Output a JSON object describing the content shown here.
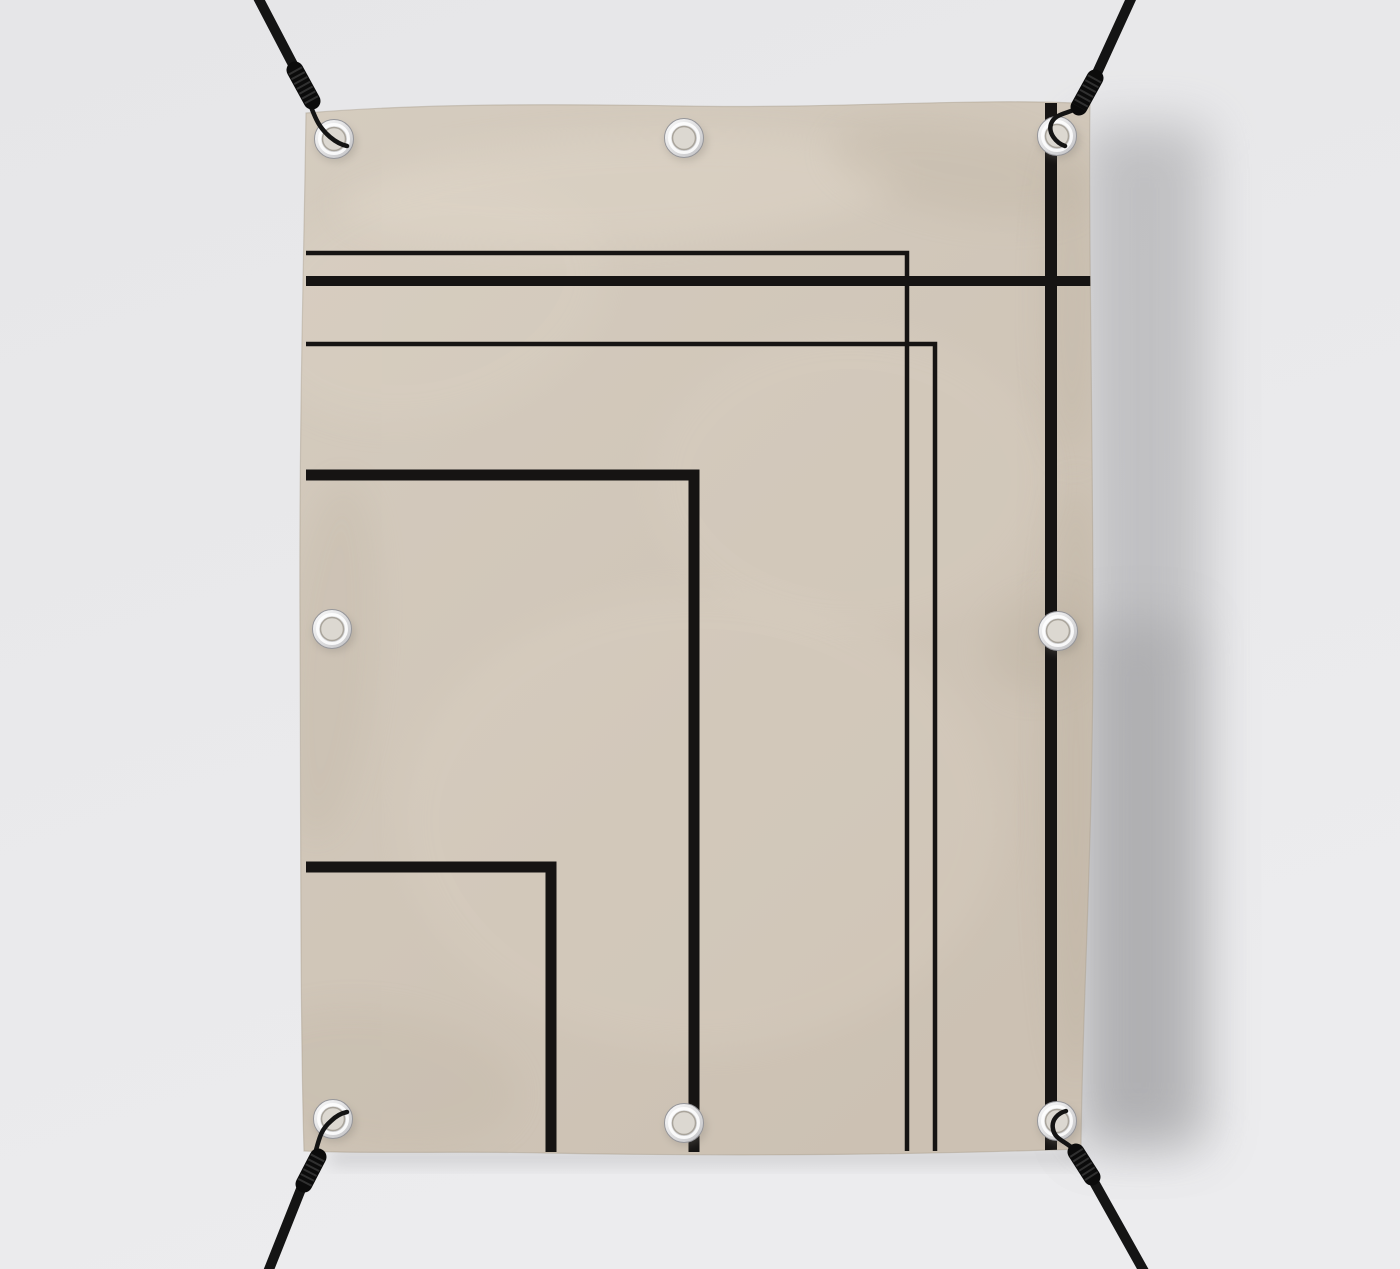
{
  "scene": {
    "description": "Beige fabric banner mockup hung by black bungee cords hooked through eight silver grommets, printed with a minimalist black geometric line pattern of nested corner frames, casting a soft shadow on a light gray wall",
    "canvas": {
      "width": 1400,
      "height": 1269
    },
    "palette": {
      "wall_top": "#e6e6e8",
      "wall_bottom": "#ececee",
      "wall_shadow": "#8f8f92",
      "under_shadow": "#a5a5a7",
      "fabric_top": "#d5ccbf",
      "fabric_bottom": "#ccc1b3",
      "fabric_shade": "#b3a795",
      "fabric_light": "#e6ddcf",
      "edge_tint": "#a99d8c",
      "line": "#161413",
      "cord": "#141414",
      "cord_coil": "#0b0b0b",
      "coil_ridge": "#3a3a3a",
      "ring_light": "#fdfdfd",
      "ring_dark": "#c0c0c3",
      "ring_rim": "#96969a",
      "ring_highlight": "#ffffff",
      "hole_fill": "#dcd8d1",
      "hole_rim": "#a9a49b",
      "grommet_shadow": "#7d786f"
    },
    "banner": {
      "outline": "M 306,113 C 430,103 560,104 683,106 C 840,109 985,97 1090,104 C 1088,200 1093,430 1093,630 C 1093,850 1082,1010 1081,1149 C 930,1154 760,1157 545,1153 C 460,1151 368,1154 304,1151 C 300,1010 301,820 300,632 C 299,420 304,260 306,113 Z"
    },
    "pattern_lines": [
      {
        "name": "thin-frame-upper",
        "points": "306,253 907,253 907,1151",
        "width": 4.5
      },
      {
        "name": "thick-horizontal",
        "points": "306,281 1091,281",
        "width": 10
      },
      {
        "name": "thin-frame-lower",
        "points": "306,344 935,344 935,1151",
        "width": 4.5
      },
      {
        "name": "thick-frame-large",
        "points": "306,475 694,475 694,1152",
        "width": 11
      },
      {
        "name": "thick-frame-small",
        "points": "306,867 551,867 551,1152",
        "width": 11
      },
      {
        "name": "thick-vertical-stripe",
        "points": "1051,103 1051,1152",
        "width": 12
      }
    ],
    "grommets": [
      {
        "name": "top-left",
        "cx": 334,
        "cy": 139
      },
      {
        "name": "top-center",
        "cx": 684,
        "cy": 138
      },
      {
        "name": "top-right",
        "cx": 1057,
        "cy": 136
      },
      {
        "name": "middle-left",
        "cx": 332,
        "cy": 629
      },
      {
        "name": "middle-right",
        "cx": 1058,
        "cy": 631
      },
      {
        "name": "bottom-left",
        "cx": 333,
        "cy": 1119
      },
      {
        "name": "bottom-center",
        "cx": 684,
        "cy": 1123
      },
      {
        "name": "bottom-right",
        "cx": 1057,
        "cy": 1121
      }
    ],
    "cords": [
      {
        "name": "top-left",
        "main": {
          "x1": 253,
          "y1": -12,
          "x2": 300,
          "y2": 78
        },
        "coil": {
          "x1": 295,
          "y1": 70,
          "x2": 312,
          "y2": 101
        },
        "hook": "M 306,95 C 314,112 315,124 330,137 C 336,142 342,145 347,146"
      },
      {
        "name": "top-right",
        "main": {
          "x1": 1136,
          "y1": -12,
          "x2": 1092,
          "y2": 84
        },
        "coil": {
          "x1": 1095,
          "y1": 78,
          "x2": 1079,
          "y2": 107
        },
        "hook": "M 1083,105 C 1071,114 1055,112 1051,124 C 1048,133 1056,143 1065,146"
      },
      {
        "name": "bottom-left",
        "main": {
          "x1": 264,
          "y1": 1282,
          "x2": 303,
          "y2": 1184
        },
        "coil": {
          "x1": 318,
          "y1": 1157,
          "x2": 304,
          "y2": 1184
        },
        "hook": "M 313,1159 C 319,1144 318,1132 331,1121 C 336,1116 342,1113 347,1112"
      },
      {
        "name": "bottom-right",
        "main": {
          "x1": 1150,
          "y1": 1282,
          "x2": 1089,
          "y2": 1173
        },
        "coil": {
          "x1": 1076,
          "y1": 1152,
          "x2": 1092,
          "y2": 1177
        },
        "hook": "M 1078,1154 C 1068,1141 1055,1141 1053,1129 C 1051,1120 1058,1113 1066,1111"
      }
    ],
    "wrinkles": [
      {
        "cx": 620,
        "cy": 190,
        "rx": 280,
        "ry": 55,
        "rot": -3,
        "tone": "light",
        "opacity": 0.3
      },
      {
        "cx": 960,
        "cy": 170,
        "rx": 130,
        "ry": 45,
        "rot": 10,
        "tone": "shade",
        "opacity": 0.2
      },
      {
        "cx": 1072,
        "cy": 300,
        "rx": 26,
        "ry": 160,
        "rot": 0,
        "tone": "shade",
        "opacity": 0.25
      },
      {
        "cx": 1076,
        "cy": 780,
        "rx": 30,
        "ry": 300,
        "rot": 0,
        "tone": "shade",
        "opacity": 0.28
      },
      {
        "cx": 1040,
        "cy": 645,
        "rx": 55,
        "ry": 45,
        "rot": -20,
        "tone": "shade",
        "opacity": 0.24
      },
      {
        "cx": 700,
        "cy": 820,
        "rx": 300,
        "ry": 230,
        "rot": 0,
        "tone": "light",
        "opacity": 0.16
      },
      {
        "cx": 330,
        "cy": 660,
        "rx": 45,
        "ry": 180,
        "rot": 5,
        "tone": "shade",
        "opacity": 0.16
      },
      {
        "cx": 430,
        "cy": 300,
        "rx": 180,
        "ry": 120,
        "rot": -15,
        "tone": "light",
        "opacity": 0.14
      },
      {
        "cx": 380,
        "cy": 1080,
        "rx": 140,
        "ry": 70,
        "rot": 8,
        "tone": "shade",
        "opacity": 0.14
      },
      {
        "cx": 850,
        "cy": 480,
        "rx": 200,
        "ry": 150,
        "rot": 0,
        "tone": "light",
        "opacity": 0.12
      }
    ],
    "wall_shadows": [
      {
        "x": 1082,
        "y": 125,
        "w": 125,
        "h": 1020,
        "opacity": 0.45
      },
      {
        "x": 1082,
        "y": 620,
        "w": 110,
        "h": 525,
        "opacity": 0.35
      },
      {
        "x": 330,
        "y": 1150,
        "w": 750,
        "h": 15,
        "opacity": 0.3
      }
    ]
  }
}
